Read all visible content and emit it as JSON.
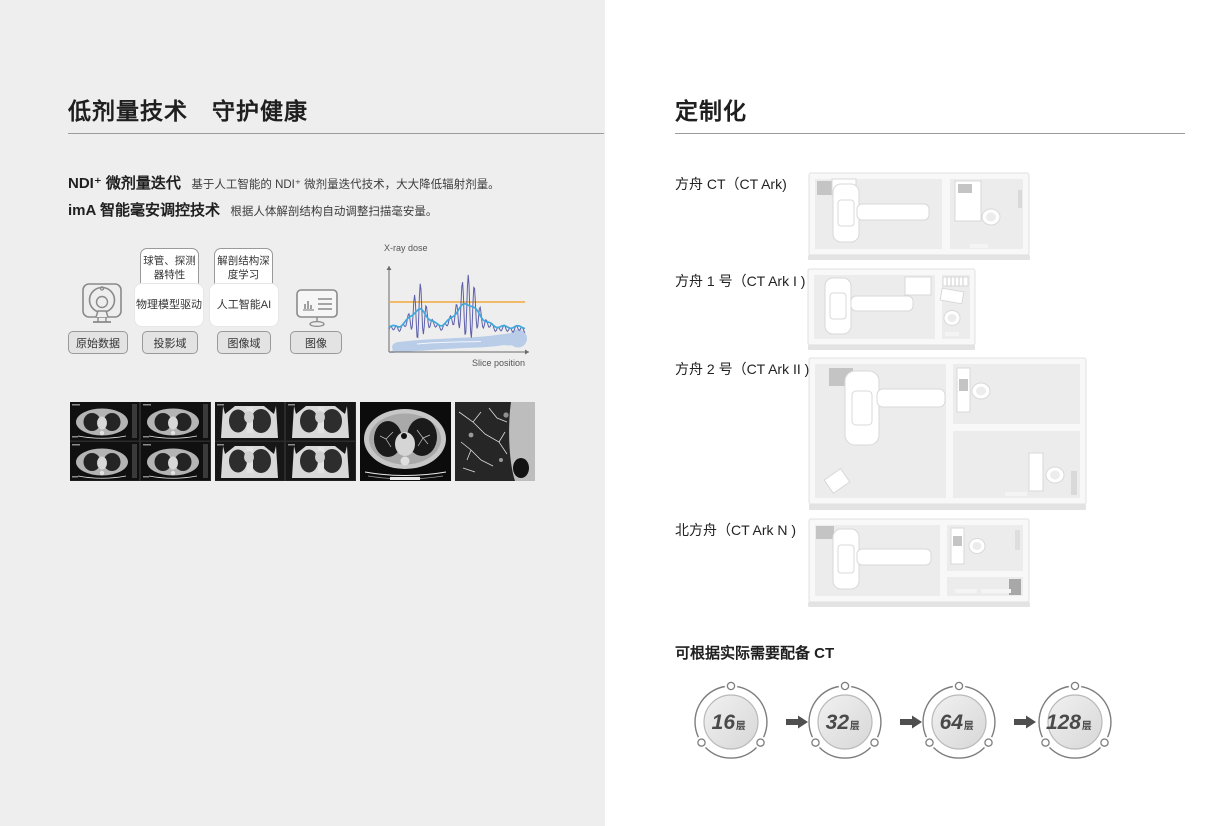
{
  "page": {
    "left_bg": "#eeeeee",
    "right_bg": "#ffffff",
    "rule_color": "#9b9b9b"
  },
  "left": {
    "title": "低剂量技术　守护健康",
    "features": [
      {
        "name": "NDI⁺ 微剂量迭代",
        "desc": "基于人工智能的 NDI⁺ 微剂量迭代技术，大大降低辐射剂量。"
      },
      {
        "name": "imA 智能毫安调控技术",
        "desc": "根据人体解剖结构自动调整扫描毫安量。"
      }
    ],
    "flow": {
      "top_boxes": [
        {
          "text": "球管、探测器特性"
        },
        {
          "text": "解剖结构深度学习"
        }
      ],
      "bottom_boxes": [
        {
          "text": "物理模型驱动"
        },
        {
          "text": "人工智能AI"
        }
      ],
      "stages": [
        {
          "label": "原始数据"
        },
        {
          "label": "投影域"
        },
        {
          "label": "图像域"
        },
        {
          "label": "图像"
        }
      ],
      "icons": [
        "ct-scanner-icon",
        "monitor-icon"
      ]
    },
    "chart": {
      "type": "line",
      "ylabel": "X-ray dose",
      "xlabel": "Slice position",
      "series": [
        "constant dose line",
        "modulated dose oscillation",
        "smoothed dose curve"
      ],
      "line_colors": {
        "constant": "#f2a93b",
        "modulated": "#5d60a8",
        "smooth": "#3fa8dd",
        "body_silhouette": "#b9cde8"
      }
    },
    "ct_images": [
      "axial-lung-grid",
      "coronal-lung-grid",
      "axial-chest-slice",
      "lung-detail-slice"
    ]
  },
  "right": {
    "title": "定制化",
    "models": [
      {
        "label": "方舟 CT（CT Ark)"
      },
      {
        "label": "方舟 1 号（CT Ark I )"
      },
      {
        "label": "方舟 2 号（CT Ark II )"
      },
      {
        "label": "北方舟（CT Ark N )"
      }
    ],
    "config_title": "可根据实际需要配备 CT",
    "ct_options": [
      {
        "num": "16",
        "unit": "层"
      },
      {
        "num": "32",
        "unit": "层"
      },
      {
        "num": "64",
        "unit": "层"
      },
      {
        "num": "128",
        "unit": "层"
      }
    ]
  }
}
